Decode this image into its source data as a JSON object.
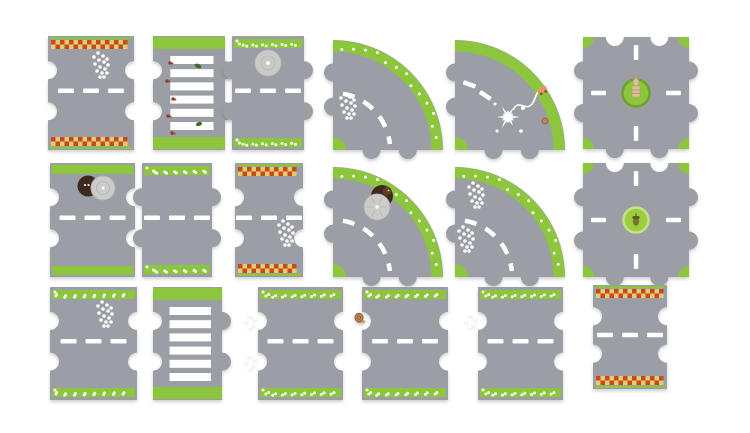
{
  "figure": {
    "kind": "toy-road-puzzle-product-photo",
    "piece_count": 18,
    "rows": 3,
    "columns": 6
  },
  "colors": {
    "background": "#ffffff",
    "road": "#9b9ea4",
    "green": "#8cc63c",
    "green_dark": "#6da32b",
    "green_light": "#c3e289",
    "roundabout_green": "#9ccd40",
    "checker_red": "#c8452f",
    "checker_yellow": "#e3cf66",
    "white": "#ffffff",
    "stone": "#cacac8",
    "stone_edge": "#b7b7b5",
    "manhole": "#3d2a1c",
    "cover": "#ccccca",
    "cover_edge": "#b2b2b0",
    "statue": "#d8c29a",
    "statue_dark": "#b49a6c",
    "acorn": "#77722f",
    "acorn_cap": "#5e5b24",
    "ant": "#9e3a27",
    "beetle": "#3e6b28",
    "orange": "#e09a6e",
    "wheel": "#7e5b43",
    "snail": "#c08552",
    "snail_dark": "#8a5a38",
    "snail_body": "#caa06e"
  },
  "pieces": [
    {
      "id": "r1p1",
      "name": "piece-straight-finish-checker",
      "type": "straight",
      "x": 48,
      "y": 36,
      "w": 86,
      "h": 114,
      "bands": "checker",
      "left": "knob",
      "right": "socket",
      "decorations": [
        {
          "type": "flower-cluster",
          "x": 46,
          "y": 17
        }
      ]
    },
    {
      "id": "r1p2",
      "name": "piece-zebra-crossing-ants",
      "type": "zebra",
      "x": 153,
      "y": 36,
      "w": 72,
      "h": 114,
      "left": "knob",
      "right": "knob",
      "decorations": [
        {
          "type": "ants"
        }
      ]
    },
    {
      "id": "r1p3",
      "name": "piece-straight-stone-well",
      "type": "straight",
      "x": 232,
      "y": 36,
      "w": 72,
      "h": 114,
      "bands": "flowers",
      "left": "socket",
      "right": "knob",
      "decorations": [
        {
          "type": "stone-disc",
          "x": 36,
          "y": 27
        }
      ]
    },
    {
      "id": "r1p4",
      "name": "piece-curve-flower-verge",
      "type": "curve",
      "x": 333,
      "y": 36,
      "w": 110,
      "h": 114,
      "band": "flowers",
      "decorations": [
        {
          "type": "flower-cluster",
          "x": 8,
          "y": 58
        },
        {
          "type": "curve-dashes"
        }
      ]
    },
    {
      "id": "r1p5",
      "name": "piece-curve-paint-splat",
      "type": "curve",
      "x": 455,
      "y": 36,
      "w": 110,
      "h": 114,
      "band": "solid",
      "decorations": [
        {
          "type": "diag-dashes"
        },
        {
          "type": "splat-trail"
        }
      ]
    },
    {
      "id": "r1p6",
      "name": "piece-crossroads-statue",
      "type": "cross",
      "x": 583,
      "y": 37,
      "w": 106,
      "h": 112,
      "decorations": [
        {
          "type": "statue-roundabout"
        }
      ]
    },
    {
      "id": "r2p1",
      "name": "piece-straight-open-manhole",
      "type": "straight",
      "x": 50,
      "y": 163,
      "w": 85,
      "h": 114,
      "bands": "green",
      "left": "knob",
      "right": "socket",
      "decorations": [
        {
          "type": "manhole",
          "x": 38,
          "y": 23
        }
      ]
    },
    {
      "id": "r2p2",
      "name": "piece-straight-flower-verge",
      "type": "straight",
      "x": 142,
      "y": 163,
      "w": 70,
      "h": 114,
      "bands": "flowers",
      "left": "socket",
      "right": "knob",
      "decorations": []
    },
    {
      "id": "r2p3",
      "name": "piece-straight-checker",
      "type": "straight",
      "x": 235,
      "y": 163,
      "w": 68,
      "h": 114,
      "bands": "checker",
      "left": "knob",
      "right": "socket",
      "decorations": [
        {
          "type": "flower-cluster",
          "x": 44,
          "y": 58
        }
      ]
    },
    {
      "id": "r2p4",
      "name": "piece-curve-hedgehog-manhole",
      "type": "curve",
      "x": 333,
      "y": 163,
      "w": 110,
      "h": 114,
      "band": "flowers",
      "decorations": [
        {
          "type": "hedgehog-manhole",
          "x": 49,
          "y": 33
        },
        {
          "type": "curve-dashes"
        }
      ]
    },
    {
      "id": "r2p5",
      "name": "piece-curve-flower-clusters",
      "type": "curve",
      "x": 455,
      "y": 163,
      "w": 110,
      "h": 114,
      "band": "flowers",
      "decorations": [
        {
          "type": "flower-cluster",
          "x": 14,
          "y": 20
        },
        {
          "type": "flower-cluster",
          "x": 4,
          "y": 64
        },
        {
          "type": "curve-dashes"
        }
      ]
    },
    {
      "id": "r2p6",
      "name": "piece-crossroads-acorn",
      "type": "cross",
      "x": 583,
      "y": 163,
      "w": 106,
      "h": 114,
      "decorations": [
        {
          "type": "acorn-roundabout"
        }
      ]
    },
    {
      "id": "r3p1",
      "name": "piece-straight-flower-cluster",
      "type": "straight",
      "x": 50,
      "y": 287,
      "w": 87,
      "h": 113,
      "bands": "flowers",
      "left": "knob",
      "right": "socket",
      "decorations": [
        {
          "type": "flower-cluster",
          "x": 48,
          "y": 15
        }
      ]
    },
    {
      "id": "r3p2",
      "name": "piece-zebra-crossing",
      "type": "zebra",
      "x": 153,
      "y": 287,
      "w": 69,
      "h": 113,
      "left": "knob",
      "right": "knob",
      "decorations": []
    },
    {
      "id": "r3p3",
      "name": "piece-straight-tab-flowers",
      "type": "straight",
      "x": 258,
      "y": 287,
      "w": 85,
      "h": 113,
      "bands": "flowers",
      "left": "knob",
      "right": "socket",
      "decorations": [
        {
          "type": "tab-flowers",
          "pos": "both"
        }
      ]
    },
    {
      "id": "r3p4",
      "name": "piece-straight-snail",
      "type": "straight",
      "x": 362,
      "y": 287,
      "w": 86,
      "h": 113,
      "bands": "flowers",
      "left": "knob",
      "right": "socket",
      "decorations": [
        {
          "type": "snail-tab"
        }
      ]
    },
    {
      "id": "r3p5",
      "name": "piece-straight-flower-verge-2",
      "type": "straight",
      "x": 478,
      "y": 287,
      "w": 85,
      "h": 113,
      "bands": "flowers",
      "left": "knob",
      "right": "socket",
      "decorations": [
        {
          "type": "tab-flowers",
          "pos": "top"
        }
      ]
    },
    {
      "id": "r3p6",
      "name": "piece-straight-checker-2",
      "type": "straight",
      "x": 593,
      "y": 285,
      "w": 74,
      "h": 104,
      "bands": "checker",
      "left": "knob",
      "right": "socket",
      "decorations": []
    }
  ]
}
